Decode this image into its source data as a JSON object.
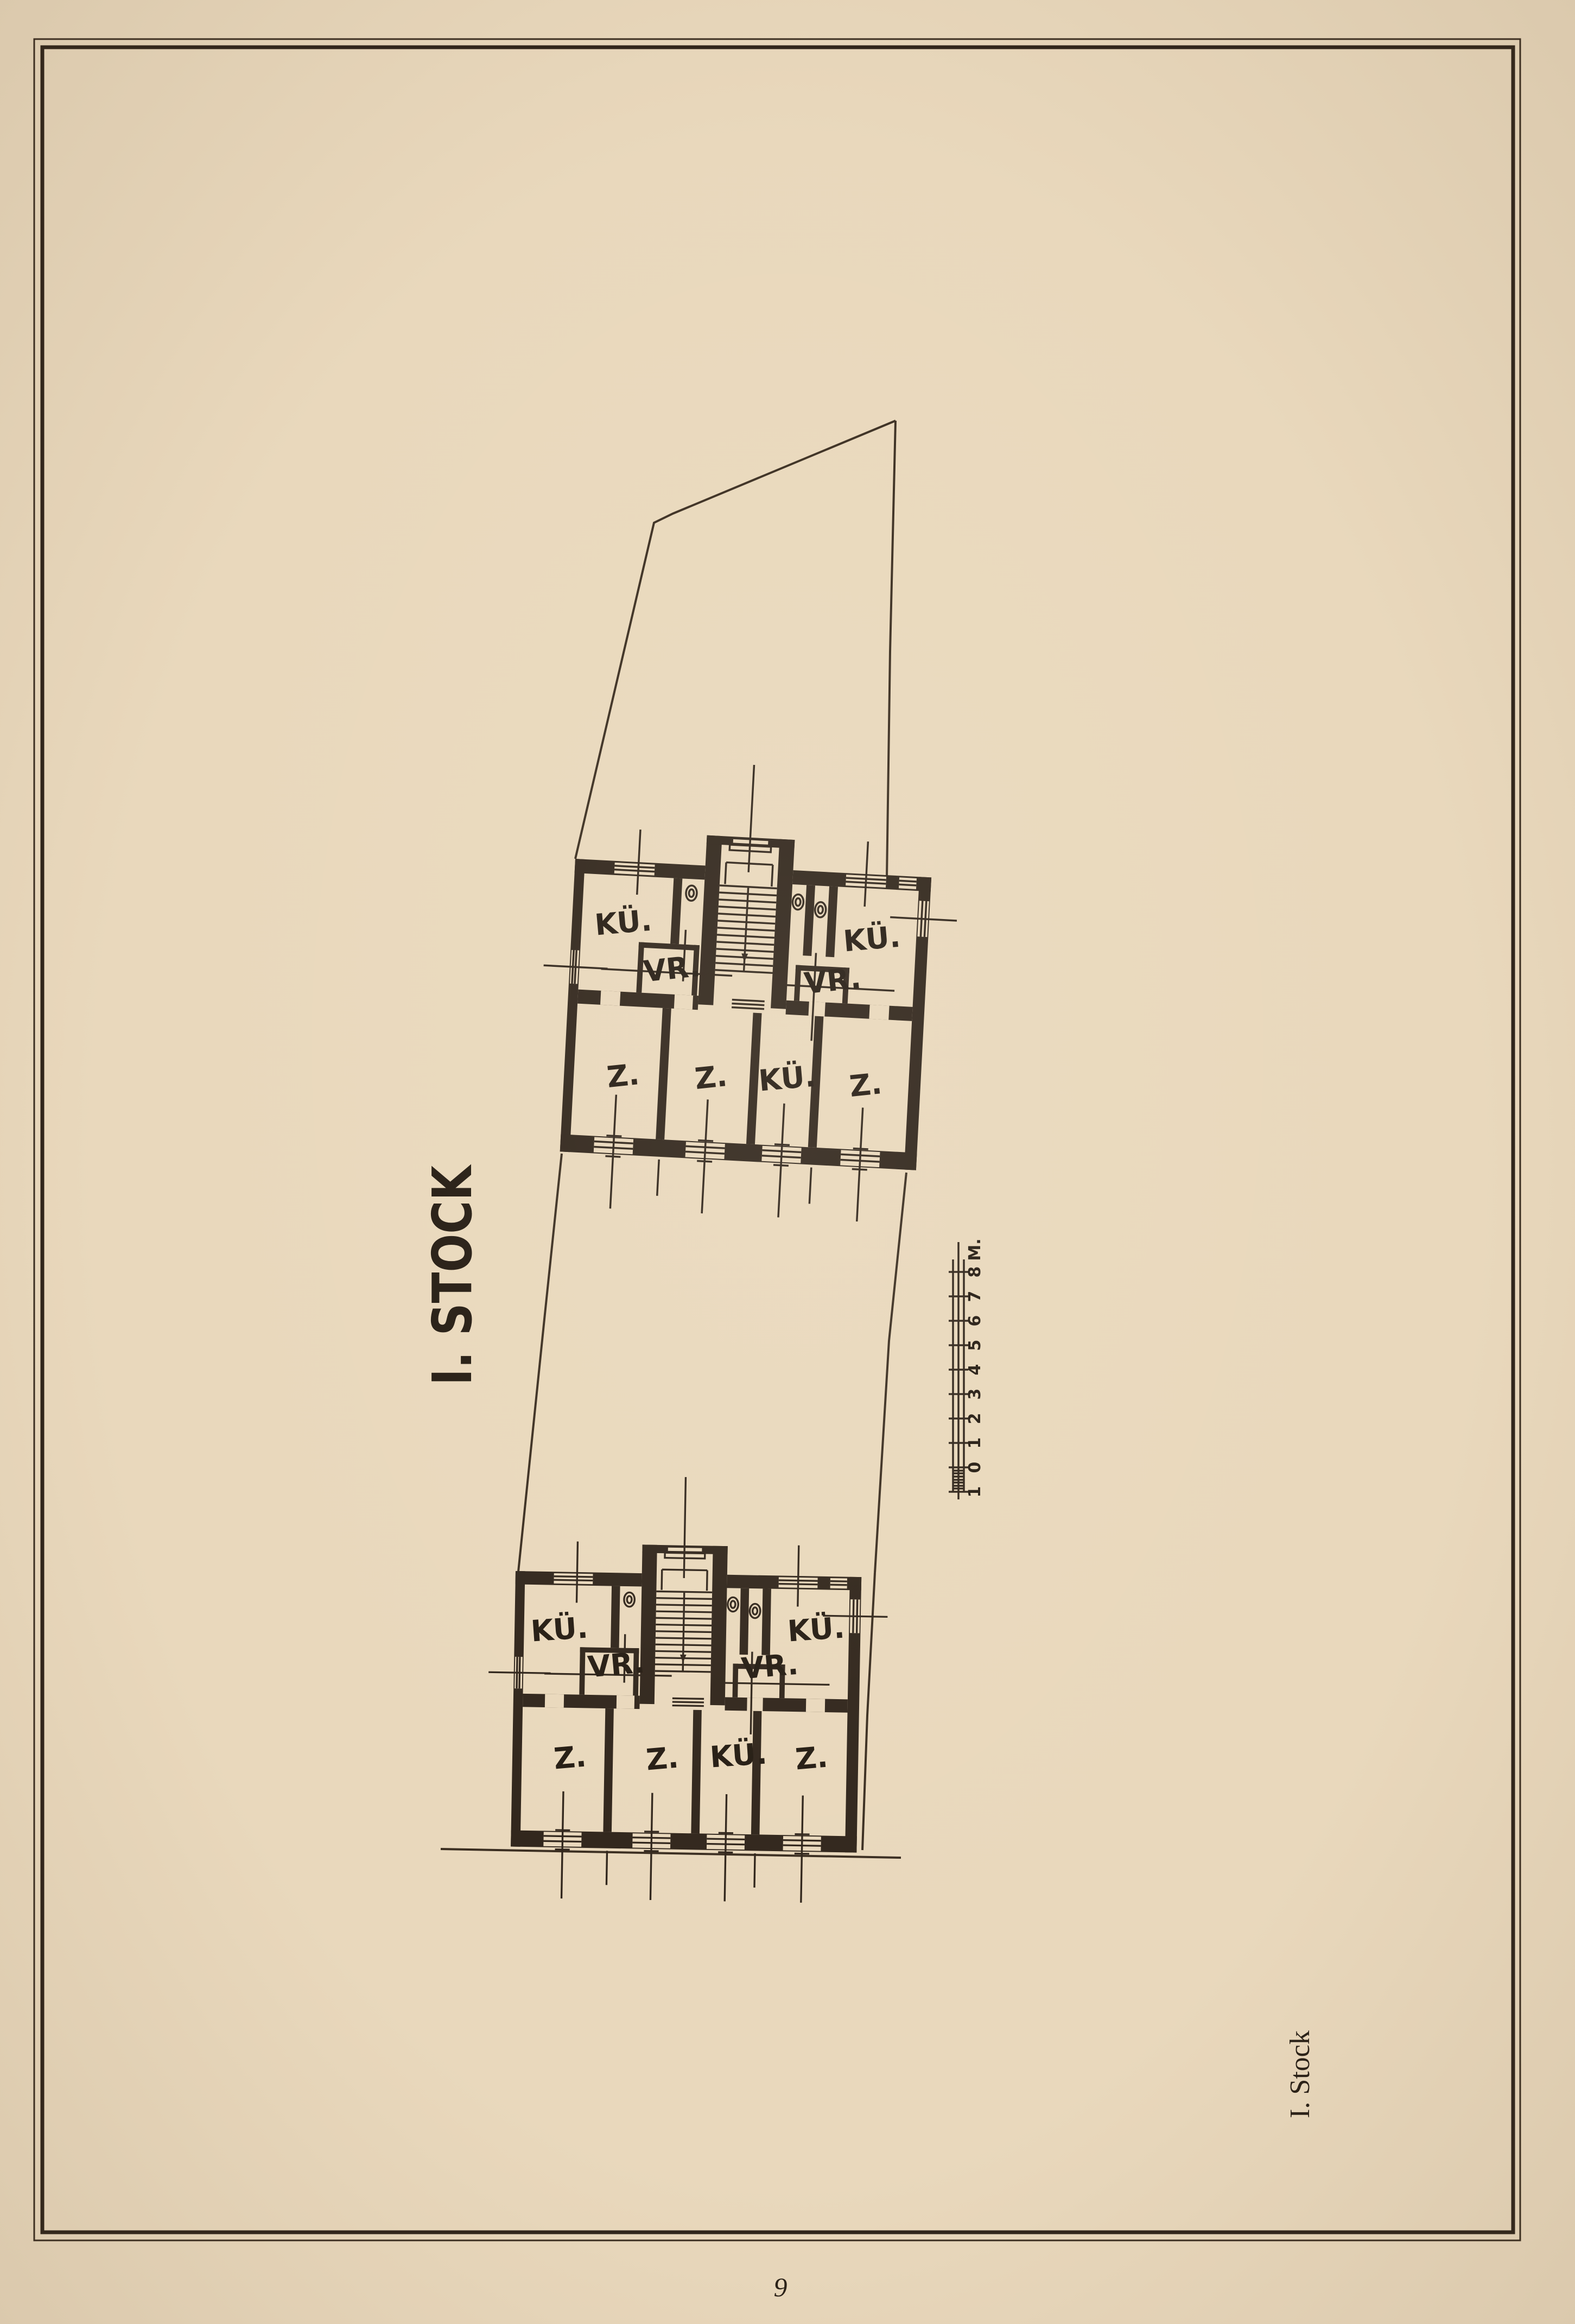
{
  "page": {
    "title": "I. STOCK",
    "side_caption": "I. Stock",
    "page_number": "9"
  },
  "scale_bar": {
    "labels": [
      "1",
      "0",
      "1",
      "2",
      "3",
      "4",
      "5",
      "6",
      "7",
      "8"
    ],
    "unit": "M."
  },
  "floor_plans": [
    {
      "id": "upper",
      "rooms": [
        {
          "label": "KÜ."
        },
        {
          "label": "VR."
        },
        {
          "label": "KÜ."
        },
        {
          "label": "VR."
        },
        {
          "label": "Z."
        },
        {
          "label": "Z."
        },
        {
          "label": "KÜ."
        },
        {
          "label": "Z."
        }
      ]
    },
    {
      "id": "lower",
      "rooms": [
        {
          "label": "KÜ."
        },
        {
          "label": "VR."
        },
        {
          "label": "KÜ."
        },
        {
          "label": "VR."
        },
        {
          "label": "Z."
        },
        {
          "label": "Z."
        },
        {
          "label": "KÜ."
        },
        {
          "label": "Z."
        }
      ]
    }
  ],
  "colors": {
    "paper": "#e9d8bc",
    "ink": "#2f241b"
  }
}
